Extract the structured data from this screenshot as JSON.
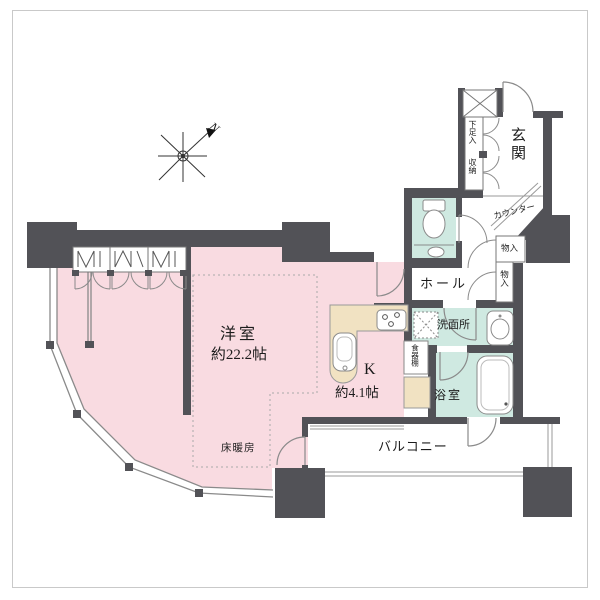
{
  "plan": {
    "rooms": {
      "western": {
        "name": "洋室",
        "size": "約22.2帖"
      },
      "kitchen": {
        "name": "K",
        "size": "約4.1帖"
      },
      "hall": {
        "name": "ホール"
      },
      "entrance": {
        "name": "玄関"
      },
      "washroom": {
        "name": "洗面所"
      },
      "bathroom": {
        "name": "浴室"
      },
      "balcony": {
        "name": "バルコニー"
      },
      "toilet": {
        "name": ""
      }
    },
    "features": {
      "floor_heating": "床暖房",
      "shoe_cabinet": "下足入",
      "storage": "収納",
      "counter": "カウンター",
      "closet_upper": "物入",
      "closet_lower": "物入",
      "dish_cabinet": "食器棚"
    },
    "compass": {
      "label": "N"
    },
    "colors": {
      "wall": "#525257",
      "room_pink": "#f9dbe1",
      "wet_teal": "#cfe9e1",
      "counter_beige": "#f1e2c2",
      "line": "#8a8a8a"
    }
  }
}
